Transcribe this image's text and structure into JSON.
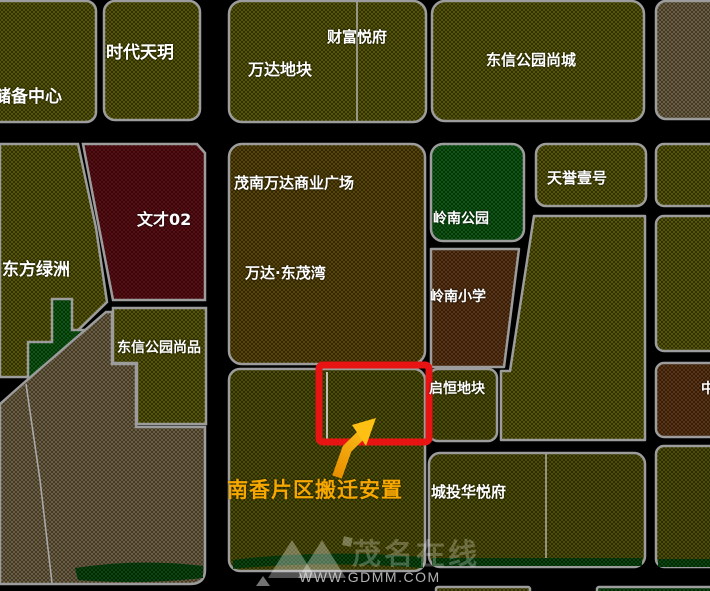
{
  "map": {
    "background_color": "#000000",
    "parcel_outline_color": "#9c9c9c",
    "highlight_box_color": "#E81414",
    "annotation_color": "#F7A800",
    "parcel_colors": {
      "olive": "#6C6C06",
      "olive_dark": "#626305",
      "gold_brown": "#6F5706",
      "tan": "#857451",
      "dark_red": "#74121A",
      "park_green": "#0F7018",
      "school_brown": "#74431A",
      "green_strip": "#0B5C12"
    },
    "parcel_labels": [
      {
        "id": "chubei-center",
        "text": "储备中心"
      },
      {
        "id": "shidai-tianyue",
        "text": "时代天玥"
      },
      {
        "id": "wanda-dikuai",
        "text": "万达地块"
      },
      {
        "id": "caifu-yuefu",
        "text": "财富悦府"
      },
      {
        "id": "dongxin-gongyuan-shangcheng",
        "text": "东信公园尚城"
      },
      {
        "id": "wencai-02",
        "text": "文才02"
      },
      {
        "id": "dongfang-lvzhou",
        "text": "东方绿洲"
      },
      {
        "id": "maonan-wanda-plaza",
        "text": "茂南万达商业广场"
      },
      {
        "id": "wanda-dongmaowan",
        "text": "万达·东茂湾"
      },
      {
        "id": "dongxin-gongyuan-shangpin",
        "text": "东信公园尚品"
      },
      {
        "id": "lingnan-park",
        "text": "岭南公园"
      },
      {
        "id": "lingnan-primary-school",
        "text": "岭南小学"
      },
      {
        "id": "tianyu-yihao",
        "text": "天誉壹号"
      },
      {
        "id": "qiheng-dikuai",
        "text": "启恒地块"
      },
      {
        "id": "chengtou-huayuefu",
        "text": "城投华悦府"
      },
      {
        "id": "right-edge-partial",
        "text": "中"
      }
    ],
    "annotation": {
      "text": "南香片区搬迁安置"
    },
    "watermark": {
      "logo_text": "茂名在线",
      "url": "WWW.GDMM.COM"
    }
  }
}
